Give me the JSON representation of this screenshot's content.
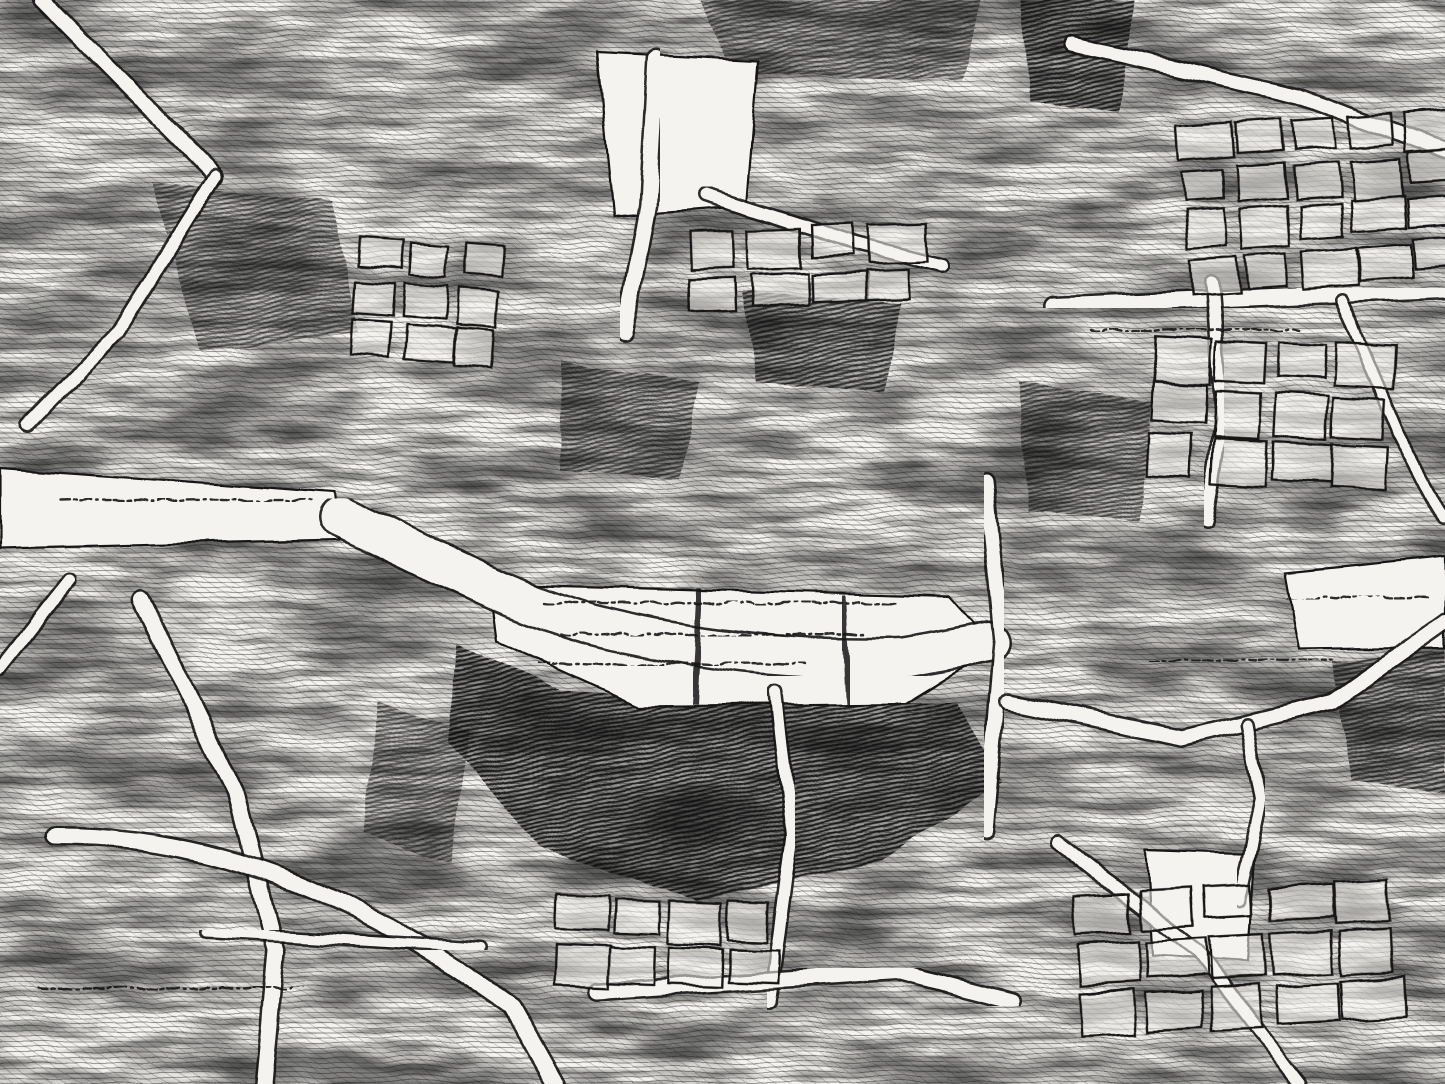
{
  "map": {
    "style": "antique-engraved-city-map",
    "width": 1445,
    "height": 1084,
    "palette": {
      "paper": "#f4f3ef",
      "ink": "#161616",
      "mid_gray": "#3a3a3a",
      "paper_translucent": "rgba(244,243,239,0.55)"
    },
    "texture": {
      "seed": 7,
      "layers": [
        {
          "name": "texture-hatch-horizontal",
          "pattern": "hatchH",
          "opacity": 0.4
        },
        {
          "name": "texture-blotch-coarse",
          "filter": "blotchCoarse",
          "opacity": 0.52
        },
        {
          "name": "texture-hatch-diagonal",
          "pattern": "hatchD",
          "opacity": 0.2
        },
        {
          "name": "texture-streaks-fine",
          "filter": "streaks",
          "opacity": 0.46
        }
      ]
    },
    "white_zones": [
      {
        "name": "clearing-north-place",
        "points": "598,52 758,60 746,206 614,216"
      },
      {
        "name": "clearing-west-quay",
        "points": "0,468 335,492 340,540 0,548"
      },
      {
        "name": "river-basin",
        "points": "490,584 950,597 996,648 906,703 640,706 497,641"
      },
      {
        "name": "clearing-east-band",
        "points": "1286,572 1445,556 1445,648 1300,650"
      },
      {
        "name": "clearing-southeast",
        "points": "1146,848 1256,852 1248,962 1152,956"
      }
    ],
    "streets": [
      {
        "name": "seine-river",
        "d": "M 340,516 C 430,558 500,598 590,624 C 690,650 800,662 905,658 L 990,642",
        "width": 38
      },
      {
        "name": "rue-north-vertical",
        "d": "M 656,58 L 648,205 L 624,332",
        "width": 15
      },
      {
        "name": "rue-north-diagonal",
        "d": "M 705,195 L 855,243 L 942,265",
        "width": 11
      },
      {
        "name": "rue-northwest-upper",
        "d": "M 42,0 L 216,176",
        "width": 13
      },
      {
        "name": "rue-northwest-lower",
        "d": "M 216,176 L 118,332 L 28,424",
        "width": 11
      },
      {
        "name": "rue-west-diagonal",
        "d": "M 68,582 L 0,668",
        "width": 11
      },
      {
        "name": "rue-southwest-long",
        "d": "M 142,600 L 236,792 L 276,952 L 264,1084",
        "width": 15
      },
      {
        "name": "rue-southwest-arc",
        "d": "M 56,836 C 230,836 372,906 512,1006 L 556,1084",
        "width": 16
      },
      {
        "name": "rue-south-cross",
        "d": "M 206,932 L 482,948",
        "width": 9
      },
      {
        "name": "rue-south-vertical",
        "d": "M 776,692 L 792,834 L 770,1002",
        "width": 11
      },
      {
        "name": "rue-south-band",
        "d": "M 598,992 L 898,972 L 1012,1002",
        "width": 14
      },
      {
        "name": "rue-east-vertical",
        "d": "M 986,482 L 1002,642 L 986,832",
        "width": 13
      },
      {
        "name": "rue-east-horizontal",
        "d": "M 1052,306 L 1445,290",
        "width": 16
      },
      {
        "name": "rue-northeast-diagonal",
        "d": "M 1072,44 L 1298,96 L 1445,150",
        "width": 13
      },
      {
        "name": "rue-east-vertical-a",
        "d": "M 1212,282 L 1222,420 L 1206,522",
        "width": 11
      },
      {
        "name": "rue-east-vertical-b",
        "d": "M 1342,300 L 1398,432 L 1444,520",
        "width": 9
      },
      {
        "name": "rue-east-band",
        "d": "M 1008,702 L 1182,738 L 1332,702 L 1445,622",
        "width": 14
      },
      {
        "name": "rue-southeast-diagonal",
        "d": "M 1058,842 L 1198,952 L 1300,1084",
        "width": 11
      },
      {
        "name": "rue-southeast-vertical",
        "d": "M 1248,724 L 1262,800 L 1240,900",
        "width": 10
      }
    ],
    "bridges": [
      {
        "name": "bridge-west",
        "d": "M 700,588 L 694,704",
        "width": 6
      },
      {
        "name": "bridge-east",
        "d": "M 843,596 L 849,704",
        "width": 6
      }
    ],
    "dark_patches": [
      {
        "name": "masse-foret-centrale",
        "points": "458,642 560,690 758,702 958,702 1002,782 878,862 698,900 540,848 448,742",
        "opacity": 0.85
      },
      {
        "name": "masse-nord-centre",
        "points": "742,292 902,302 884,392 756,382",
        "opacity": 0.7
      },
      {
        "name": "masse-nord-centre-ouest",
        "points": "562,362 700,382 680,478 560,468",
        "opacity": 0.55
      },
      {
        "name": "masse-nord-est",
        "points": "1022,0 1132,0 1120,112 1030,102",
        "opacity": 0.8
      },
      {
        "name": "masse-est-centrale",
        "points": "1018,382 1152,402 1140,522 1028,512",
        "opacity": 0.55
      },
      {
        "name": "masse-sud-est",
        "points": "1332,662 1445,650 1445,792 1352,782",
        "opacity": 0.65
      },
      {
        "name": "masse-nord-ouest",
        "points": "152,182 332,202 358,332 200,352",
        "opacity": 0.5
      },
      {
        "name": "masse-sud-centre-ouest",
        "points": "378,702 470,732 450,862 362,832",
        "opacity": 0.5
      },
      {
        "name": "masse-nord-bande",
        "points": "700,0 980,0 962,82 732,72",
        "opacity": 0.5
      }
    ],
    "block_clusters": [
      {
        "name": "ilots-nord-est",
        "x": 1180,
        "y": 128,
        "cols": 5,
        "rows": 4,
        "cw": 46,
        "ch": 33,
        "gap": 10,
        "rot": -4
      },
      {
        "name": "ilots-est",
        "x": 1156,
        "y": 336,
        "cols": 4,
        "rows": 3,
        "cw": 50,
        "ch": 38,
        "gap": 11,
        "rot": 3
      },
      {
        "name": "ilots-sud-est",
        "x": 1076,
        "y": 896,
        "cols": 5,
        "rows": 3,
        "cw": 54,
        "ch": 38,
        "gap": 11,
        "rot": -3
      },
      {
        "name": "ilots-sud-centre",
        "x": 556,
        "y": 896,
        "cols": 4,
        "rows": 2,
        "cw": 48,
        "ch": 36,
        "gap": 10,
        "rot": 2
      },
      {
        "name": "ilots-nord-centre",
        "x": 688,
        "y": 232,
        "cols": 4,
        "rows": 2,
        "cw": 50,
        "ch": 34,
        "gap": 10,
        "rot": -2
      },
      {
        "name": "ilots-ouest",
        "x": 356,
        "y": 238,
        "cols": 3,
        "rows": 3,
        "cw": 44,
        "ch": 32,
        "gap": 10,
        "rot": 4
      }
    ],
    "scribbles": [
      {
        "name": "pseudo-text-basin-1",
        "x1": 545,
        "x2": 895,
        "y": 603,
        "amp": 4
      },
      {
        "name": "pseudo-text-basin-2",
        "x1": 560,
        "x2": 860,
        "y": 634,
        "amp": 4
      },
      {
        "name": "pseudo-text-basin-3",
        "x1": 540,
        "x2": 800,
        "y": 664,
        "amp": 4
      },
      {
        "name": "pseudo-text-west-quay",
        "x1": 60,
        "x2": 300,
        "y": 500,
        "amp": 3
      },
      {
        "name": "pseudo-text-east-band",
        "x1": 1288,
        "x2": 1425,
        "y": 598,
        "amp": 4
      },
      {
        "name": "pseudo-text-east-mid",
        "x1": 1150,
        "x2": 1320,
        "y": 660,
        "amp": 3
      },
      {
        "name": "pseudo-text-southwest",
        "x1": 40,
        "x2": 300,
        "y": 988,
        "amp": 4
      },
      {
        "name": "pseudo-text-north-right",
        "x1": 1090,
        "x2": 1290,
        "y": 330,
        "amp": 3
      }
    ],
    "scribble_dash": "9 4 3 4 12 5 2 5 7 3"
  }
}
